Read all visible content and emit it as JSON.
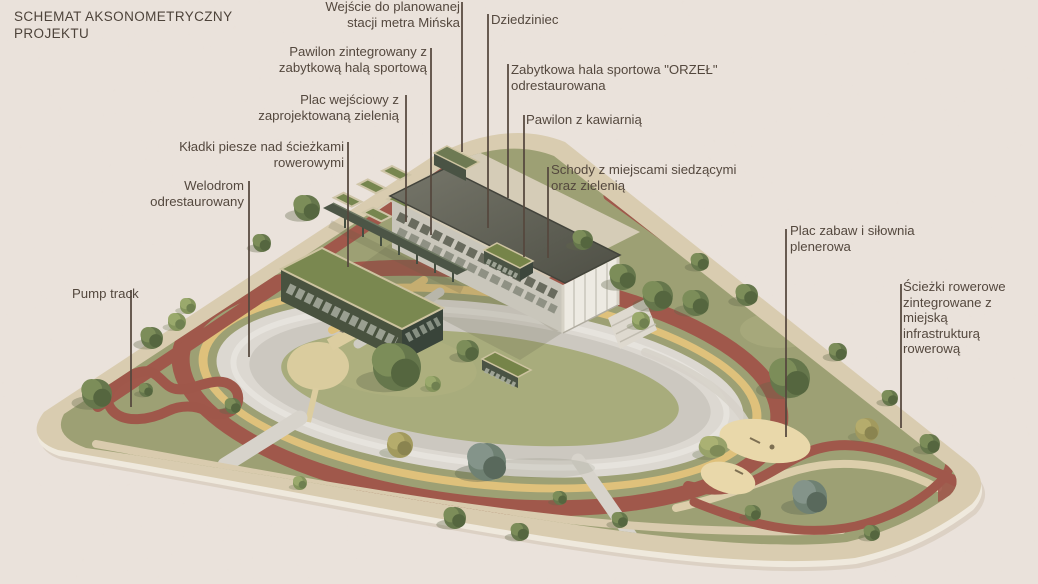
{
  "title": {
    "text": "SCHEMAT AKSONOMETRYCZNY\nPROJEKTU"
  },
  "labels": {
    "metro": {
      "text": "Wejście do planowanej\nstacji metra Mińska"
    },
    "dziedziniec": {
      "text": "Dziedziniec"
    },
    "pawilon_zintegrowany": {
      "text": "Pawilon zintegrowany z\nzabytkową halą sportową"
    },
    "zabytkowa_hala": {
      "text": "Zabytkowa hala sportowa \"ORZEŁ\"\nodrestaurowana"
    },
    "plac_wejsciowy": {
      "text": "Plac wejściowy z\nzaprojektowaną zielenią"
    },
    "pawilon_kawiarnia": {
      "text": "Pawilon z kawiarnią"
    },
    "kladki": {
      "text": "Kładki piesze nad ścieżkami\nrowerowymi"
    },
    "welodrom": {
      "text": "Welodrom\nodrestaurowany"
    },
    "schody": {
      "text": "Schody z miejscami siedzącymi\noraz zielenią"
    },
    "pump_track": {
      "text": "Pump track"
    },
    "plac_zabaw": {
      "text": "Plac zabaw i siłownia\nplenerowa"
    },
    "sciezki_rowerowe": {
      "text": "Ścieżki rowerowe\nzintegrowane z miejską\ninfrastrukturą rowerową"
    }
  },
  "colors": {
    "background": "#eae2db",
    "grass": "#9da074",
    "bike_path_red": "#a0584b",
    "running_track_yellow": "#dfc17b",
    "velodrome_track": "#dcd8d1",
    "site_border": "#d9ccb0",
    "label_text": "#54483e"
  }
}
